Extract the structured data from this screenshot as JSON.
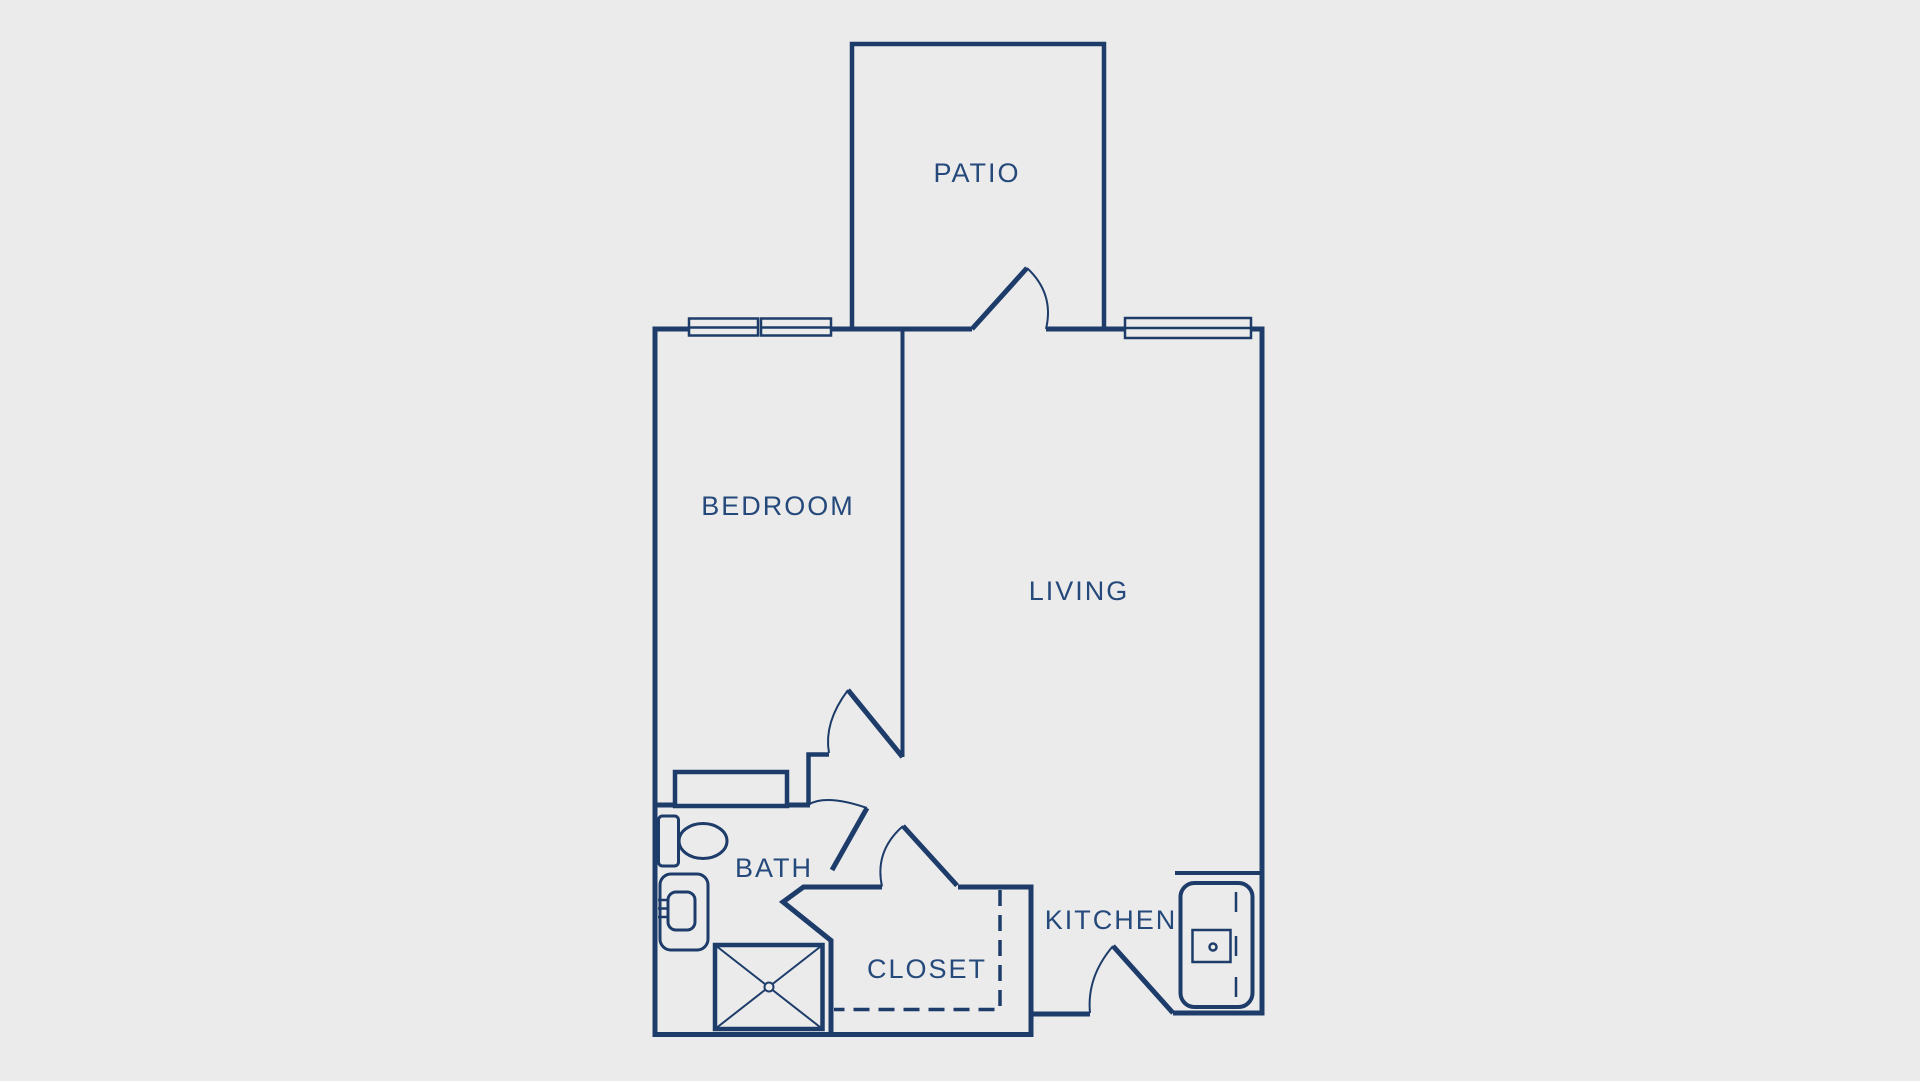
{
  "title": "One bedroom apartment floor plan",
  "colors": {
    "background": "#ebebeb",
    "line": "#1d3c6a",
    "text": "#25497b"
  },
  "plan": {
    "rooms": [
      {
        "id": "patio",
        "label": "PATIO"
      },
      {
        "id": "bedroom",
        "label": "BEDROOM"
      },
      {
        "id": "living",
        "label": "LIVING"
      },
      {
        "id": "bath",
        "label": "BATH"
      },
      {
        "id": "closet",
        "label": "CLOSET"
      },
      {
        "id": "kitchen",
        "label": "KITCHEN"
      }
    ],
    "doors": [
      {
        "id": "patio-door"
      },
      {
        "id": "bedroom-door"
      },
      {
        "id": "bath-door"
      },
      {
        "id": "closet-door"
      },
      {
        "id": "kitchen-door"
      }
    ],
    "windows": [
      {
        "id": "bedroom-window-left"
      },
      {
        "id": "bedroom-window-right"
      },
      {
        "id": "living-window"
      }
    ],
    "fixtures": [
      {
        "id": "dresser"
      },
      {
        "id": "toilet"
      },
      {
        "id": "bath-sink"
      },
      {
        "id": "shower"
      },
      {
        "id": "kitchen-range"
      }
    ]
  }
}
